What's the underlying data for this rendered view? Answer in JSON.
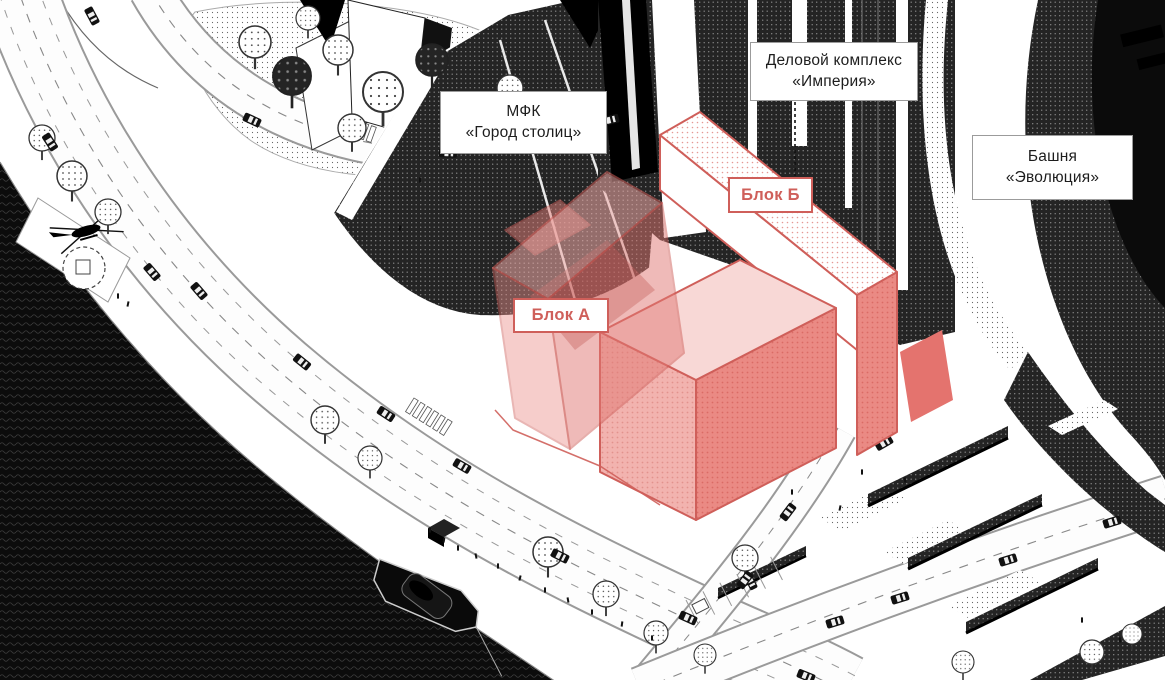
{
  "labels": {
    "mfk": {
      "line1": "МФК",
      "line2": "«Город столиц»"
    },
    "imperia": {
      "line1": "Деловой комплекс",
      "line2": "«Империя»"
    },
    "evolution": {
      "line1": "Башня",
      "line2": "«Эволюция»"
    },
    "block_a": {
      "text": "Блок А"
    },
    "block_b": {
      "text": "Блок Б"
    }
  },
  "colors": {
    "accent_red": "#cf5f5a",
    "red_face": "#e4736e",
    "pink_face": "#f2b2ae",
    "pink_light": "#f8d8d6",
    "ink": "#111111",
    "water": "#0c0c0c"
  },
  "features": [
    "river-water",
    "motorboat",
    "helicopter",
    "helipad",
    "embankment-roads",
    "cars",
    "trees",
    "pedestrians",
    "city-of-capitals-tower",
    "imperia-tower",
    "evolution-tower",
    "block-a-volume",
    "block-b-volume"
  ]
}
